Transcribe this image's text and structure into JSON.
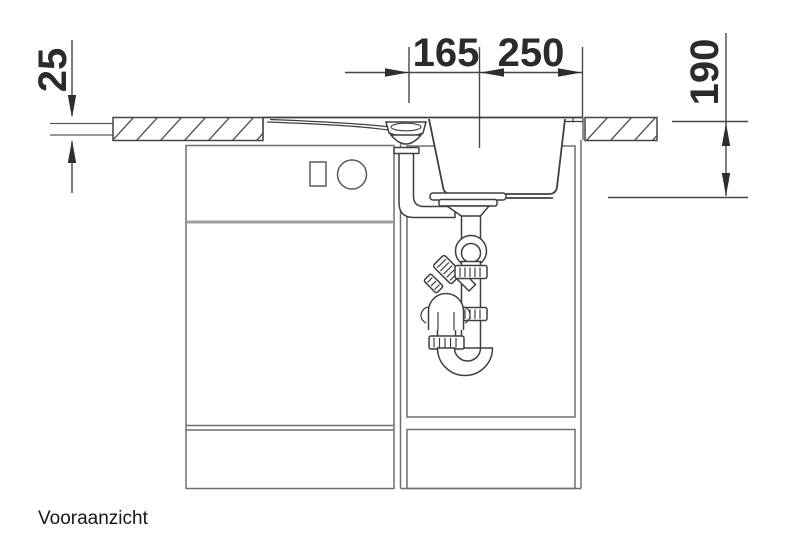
{
  "drawing": {
    "caption": "Vooraanzicht",
    "dimensions": {
      "countertop_thickness": "25",
      "drain_to_bowl_center": "165",
      "bowl_center_to_edge": "250",
      "bowl_depth": "190"
    }
  },
  "colors": {
    "background": "#ffffff",
    "drawing_line": "#3f3f3f",
    "cabinet_line": "#6e6e6e",
    "divider_line": "#a0a0a0",
    "dimension_line": "#474747",
    "dimension_text": "#2b2b2b",
    "caption_text": "#161616"
  }
}
